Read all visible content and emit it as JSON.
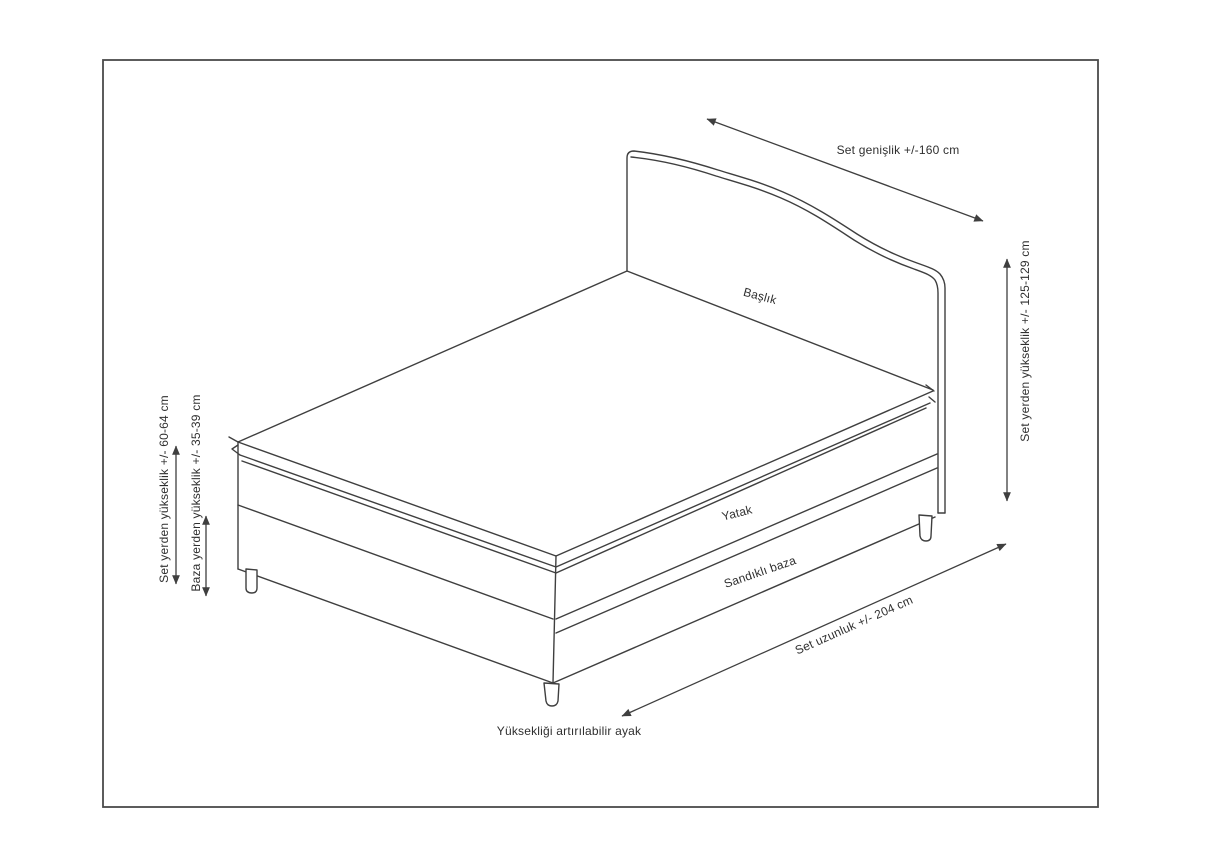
{
  "figure": {
    "type": "technical-drawing",
    "subject": "bed-set-with-storage-base-dimensions",
    "part_labels": {
      "headboard": "Başlık",
      "mattress": "Yatak",
      "storage_base": "Sandıklı baza",
      "adjustable_foot": "Yüksekliği artırılabilir ayak"
    },
    "dimension_labels": {
      "set_width": "Set genişlik +/-160 cm",
      "set_total_height_from_floor": "Set yerden yükseklik +/- 125-129 cm",
      "set_height_from_floor": "Set yerden yükseklik +/- 60-64 cm",
      "base_height_from_floor": "Baza yerden yükseklik +/- 35-39 cm",
      "set_length": "Set uzunluk +/- 204 cm"
    },
    "colors": {
      "background": "#ffffff",
      "line": "#3f3f3f",
      "text": "#2f2f2f",
      "frame": "#4a4a4a"
    }
  }
}
